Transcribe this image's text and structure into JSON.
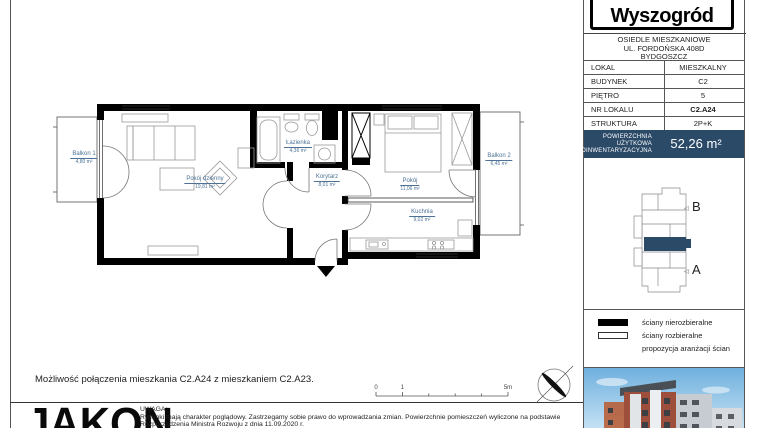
{
  "document": {
    "brand": "Wyszogród",
    "estate": {
      "line1": "OSIEDLE MIESZKANIOWE",
      "line2": "UL. FORDOŃSKA 408D",
      "line3": "BYDGOSZCZ"
    }
  },
  "info_table": {
    "rows": [
      {
        "label": "LOKAL",
        "value": "MIESZKALNY"
      },
      {
        "label": "BUDYNEK",
        "value": "C2"
      },
      {
        "label": "PIĘTRO",
        "value": "5"
      },
      {
        "label": "NR LOKALU",
        "value": "C2.A24"
      },
      {
        "label": "STRUKTURA",
        "value": "2P+K"
      }
    ]
  },
  "area_banner": {
    "line1": "POWIERZCHNIA",
    "line2": "UŻYTKOWA",
    "line3": "POINWENTARYZACYJNA",
    "value": "52,26 m²"
  },
  "key_plan": {
    "section_top": "B",
    "section_bottom": "A"
  },
  "legend": {
    "items": [
      {
        "label": "ściany nierozbieralne"
      },
      {
        "label": "ściany rozbieralne"
      },
      {
        "label": "propozycja aranżacji ścian"
      }
    ]
  },
  "floor_plan": {
    "rooms": [
      {
        "name": "Balkon 1",
        "area": "4,80 m²"
      },
      {
        "name": "Pokój dzienny",
        "area": "19,81 m²"
      },
      {
        "name": "Łazienka",
        "area": "4,36 m²"
      },
      {
        "name": "Korytarz",
        "area": "8,01 m²"
      },
      {
        "name": "Pokój",
        "area": "11,06 m²"
      },
      {
        "name": "Kuchnia",
        "area": "9,02 m²"
      },
      {
        "name": "Balkon 2",
        "area": "6,45 m²"
      }
    ]
  },
  "note": "Możliwość połączenia mieszkania C2.A24 z mieszkaniem C2.A23.",
  "scale_bar": {
    "labels": [
      "0",
      "1",
      "5m"
    ]
  },
  "footer": {
    "brand": "JAKON",
    "notice_title": "UWAGA:",
    "notice_line1": "Rysunki mają charakter poglądowy. Zastrzegamy sobie prawo do wprowadzania zmian. Powierzchnie pomieszczeń wyliczone na podstawie",
    "notice_line2": "Rozporządzenia Ministra Rozwoju z dnia 11.09.2020 r."
  },
  "colors": {
    "accent_navy": "#2b4a68",
    "room_label_blue": "#4d7296"
  }
}
